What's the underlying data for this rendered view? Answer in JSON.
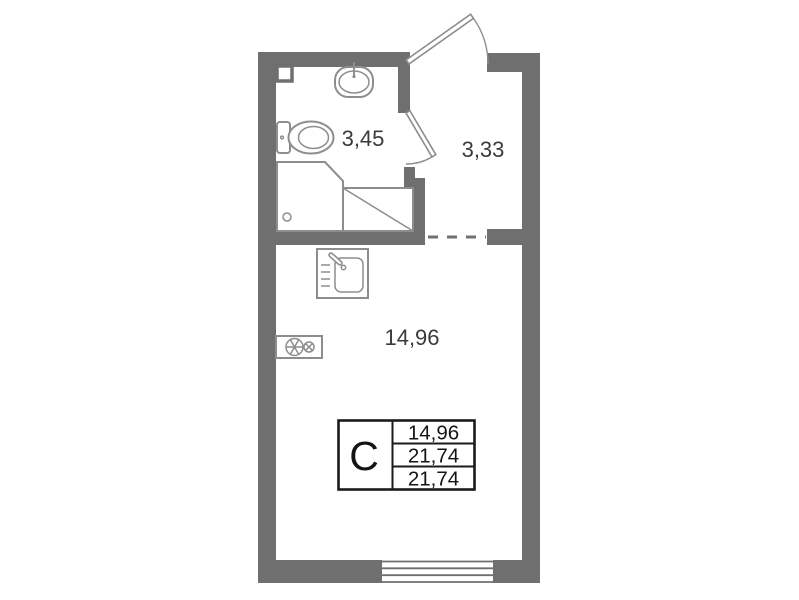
{
  "colors": {
    "wall": "#6f6f6f",
    "fixture": "#8d8d8d",
    "label": "#3a3a3a",
    "border": "#1b1b1b",
    "bg": "#ffffff"
  },
  "plan": {
    "rooms": {
      "bathroom": {
        "name": "bathroom",
        "area": "3,45"
      },
      "hallway": {
        "name": "hallway",
        "area": "3,33"
      },
      "main_room": {
        "name": "main-room",
        "area": "14,96"
      }
    },
    "legend": {
      "unit_type": "С",
      "values": [
        "14,96",
        "21,74",
        "21,74"
      ]
    },
    "fixtures": [
      "entrance-door",
      "bathroom-door",
      "vent-shaft",
      "bathroom-sink",
      "toilet",
      "shower-tray",
      "hatched-area",
      "kitchen-sink",
      "stove-2-burner",
      "window"
    ]
  }
}
